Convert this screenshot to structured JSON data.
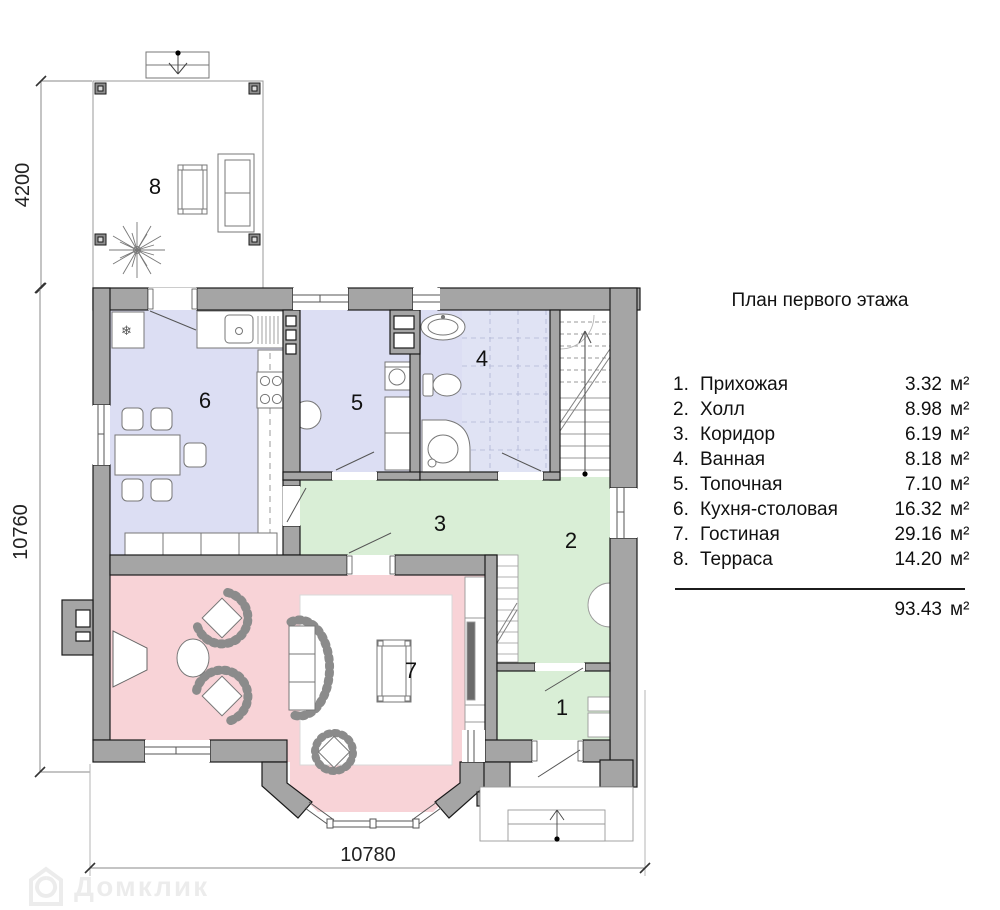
{
  "legend": {
    "title": "План первого этажа",
    "rows": [
      {
        "num": "1.",
        "name": "Прихожая",
        "area": "3.32",
        "unit": "м²"
      },
      {
        "num": "2.",
        "name": "Холл",
        "area": "8.98",
        "unit": "м²"
      },
      {
        "num": "3.",
        "name": "Коридор",
        "area": "6.19",
        "unit": "м²"
      },
      {
        "num": "4.",
        "name": "Ванная",
        "area": "8.18",
        "unit": "м²"
      },
      {
        "num": "5.",
        "name": "Топочная",
        "area": "7.10",
        "unit": "м²"
      },
      {
        "num": "6.",
        "name": "Кухня-столовая",
        "area": "16.32",
        "unit": "м²"
      },
      {
        "num": "7.",
        "name": "Гостиная",
        "area": "29.16",
        "unit": "м²"
      },
      {
        "num": "8.",
        "name": "Терраса",
        "area": "14.20",
        "unit": "м²"
      }
    ],
    "total": {
      "area": "93.43",
      "unit": "м²"
    }
  },
  "dimensions": {
    "terrace_height": "4200",
    "left_height": "10760",
    "bottom_width": "10780"
  },
  "rooms": {
    "r1": "1",
    "r2": "2",
    "r3": "3",
    "r4": "4",
    "r5": "5",
    "r6": "6",
    "r7": "7",
    "r8": "8"
  },
  "icons": {
    "snowflake": "❄"
  },
  "watermark": {
    "text": "Домклик"
  },
  "colors": {
    "wall": "#a5a5a5",
    "room_blue": "#dcdef3",
    "room_green": "#d9eed6",
    "room_pink": "#f8d3d7",
    "tile": "#e0e3f4"
  }
}
